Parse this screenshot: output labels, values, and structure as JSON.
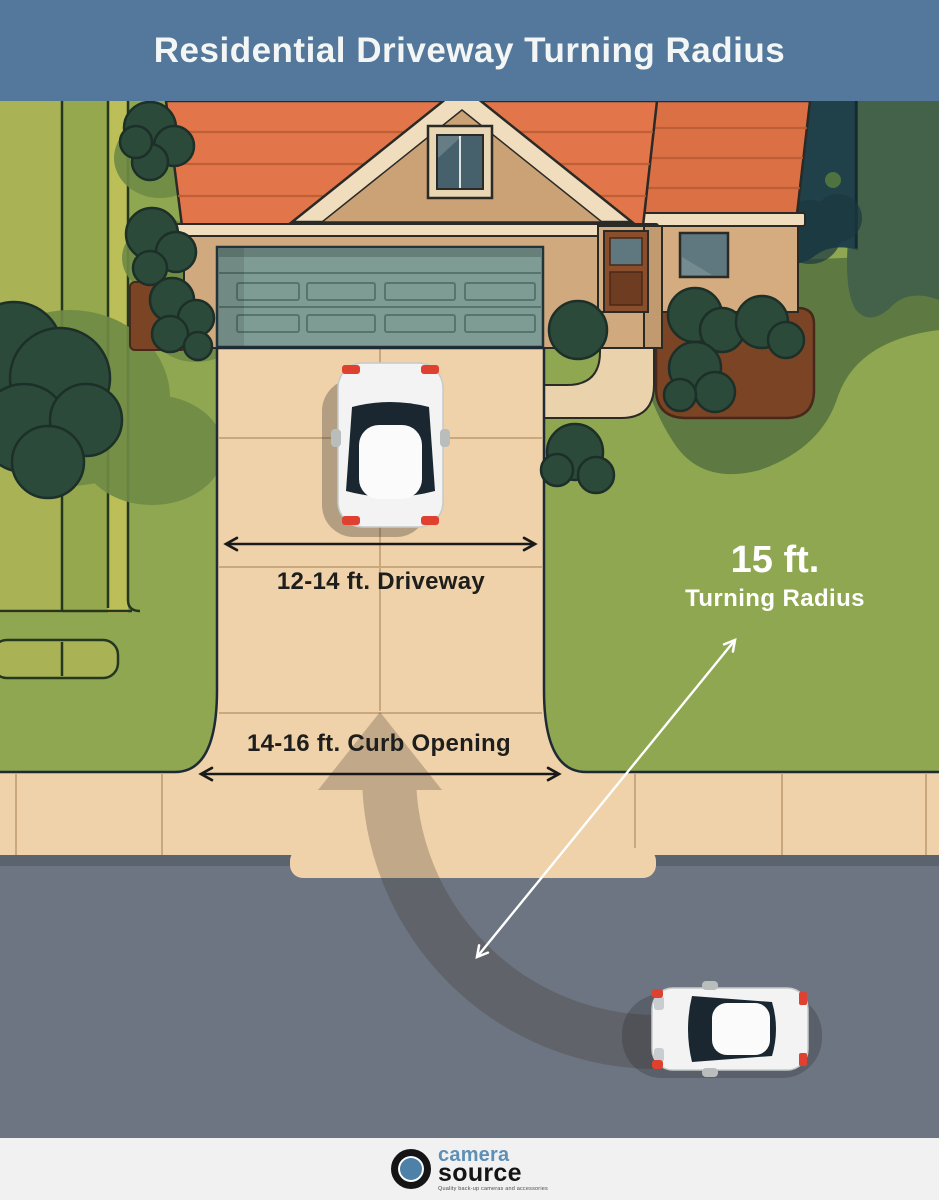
{
  "header": {
    "title": "Residential Driveway Turning Radius"
  },
  "diagram": {
    "driveway_label": "12-14 ft. Driveway",
    "curb_label": "14-16 ft. Curb Opening",
    "radius_value": "15 ft.",
    "radius_caption": "Turning Radius",
    "colors": {
      "header_bg": "#53789B",
      "lawn": "#8FA750",
      "lawn_shade": "#5E7A42",
      "tree_canopy": "#20404A",
      "bush": "#2C4A3A",
      "roof": "#E2764A",
      "fascia": "#EFDDBE",
      "wall": "#D0A97E",
      "garage_door": "#7E9B94",
      "front_door": "#8A4E2C",
      "mulch": "#7A4425",
      "pavement": "#EFD2AA",
      "pavement_joint": "#C9A87D",
      "road": "#6C7581",
      "car_accent_red": "#E0402F",
      "turn_path": "#3A3028",
      "measure_arrow": "#1A1A1A",
      "radius_arrow": "#FFFFFF",
      "footer_bg": "#F1F1F2",
      "logo_blue": "#4E81A8"
    }
  },
  "footer": {
    "brand_top": "camera",
    "brand_bottom": "source",
    "tagline": "Quality back-up cameras and accessories"
  }
}
